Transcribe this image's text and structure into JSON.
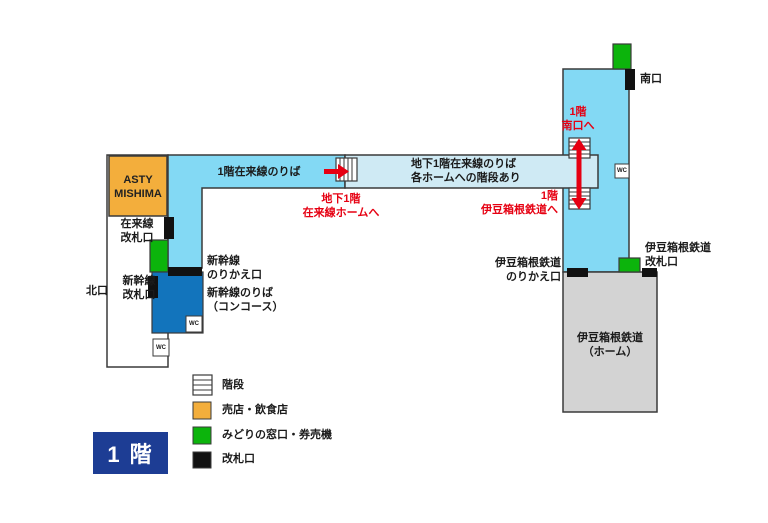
{
  "colors": {
    "concourse_blue": "#83D9F4",
    "underpass_light_blue": "#CFEAF4",
    "shinkansen_blue": "#1274BC",
    "floor_badge_navy": "#1D3D94",
    "shop_orange": "#F3AE3C",
    "ticket_green": "#0CB40C",
    "gate_black": "#111111",
    "platform_gray": "#D3D3D3",
    "arrow_red": "#E60012",
    "outline_gray": "#3A3A3A"
  },
  "map": {
    "asty": "ASTY\nMISHIMA",
    "north_exit": "北口",
    "south_exit": "南口",
    "jr_local_gate": "在来線\n改札口",
    "shinkansen_gate": "新幹線\n改札口",
    "shinkansen_transfer_gate": "新幹線\nのりかえ口",
    "shinkansen_platform": "新幹線のりば\n（コンコース）",
    "floor1_local_platform": "1階在来線のりば",
    "b1_local_platform_note": "地下1階在来線のりば\n各ホームへの階段あり",
    "to_b1_local_platform": "地下1階\n在来線ホームへ",
    "to_south_exit": "1階\n南口へ",
    "to_izuhakone": "1階\n伊豆箱根鉄道へ",
    "izuhakone_transfer_gate": "伊豆箱根鉄道\nのりかえ口",
    "izuhakone_gate": "伊豆箱根鉄道\n改札口",
    "izuhakone_platform": "伊豆箱根鉄道\n（ホーム）",
    "wc": "WC"
  },
  "legend": {
    "items": [
      {
        "name": "stairs",
        "label": "階段"
      },
      {
        "name": "shops",
        "label": "売店・飲食店",
        "color": "#F3AE3C"
      },
      {
        "name": "ticket-office",
        "label": "みどりの窓口・券売機",
        "color": "#0CB40C"
      },
      {
        "name": "gates",
        "label": "改札口",
        "color": "#111111"
      }
    ],
    "floor_badge": "1 階"
  }
}
